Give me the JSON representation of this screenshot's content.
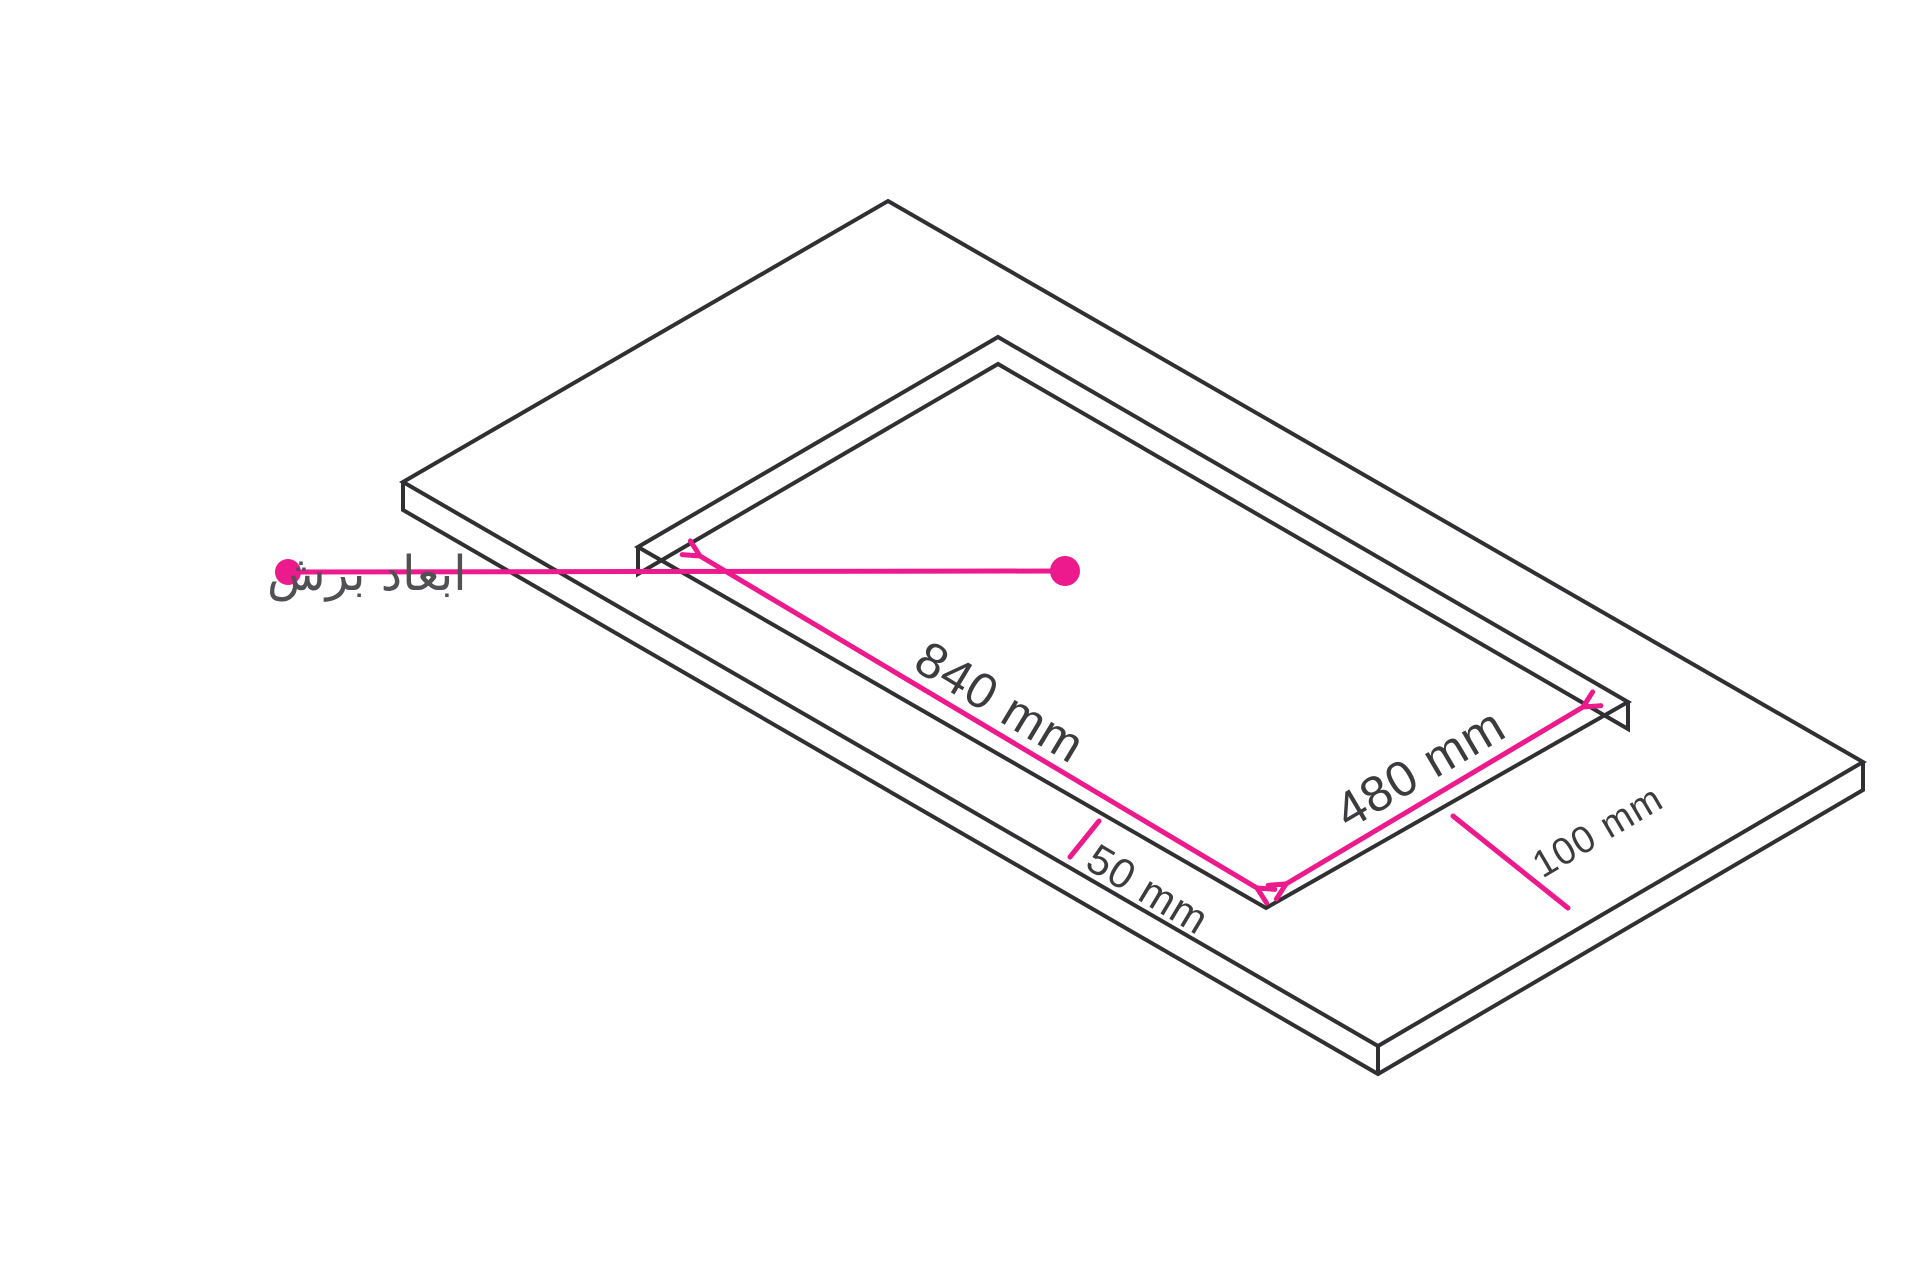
{
  "diagram": {
    "caption": "ابعاد برش",
    "dimensions": {
      "cutout_length": "840 mm",
      "cutout_width": "480 mm",
      "front_clearance": "50 mm",
      "side_clearance": "100 mm"
    },
    "colors": {
      "accent": "#EC1A8C",
      "line": "#303032",
      "label": "#3C3C3E",
      "caption": "#515153",
      "background": "#FFFFFF"
    }
  }
}
